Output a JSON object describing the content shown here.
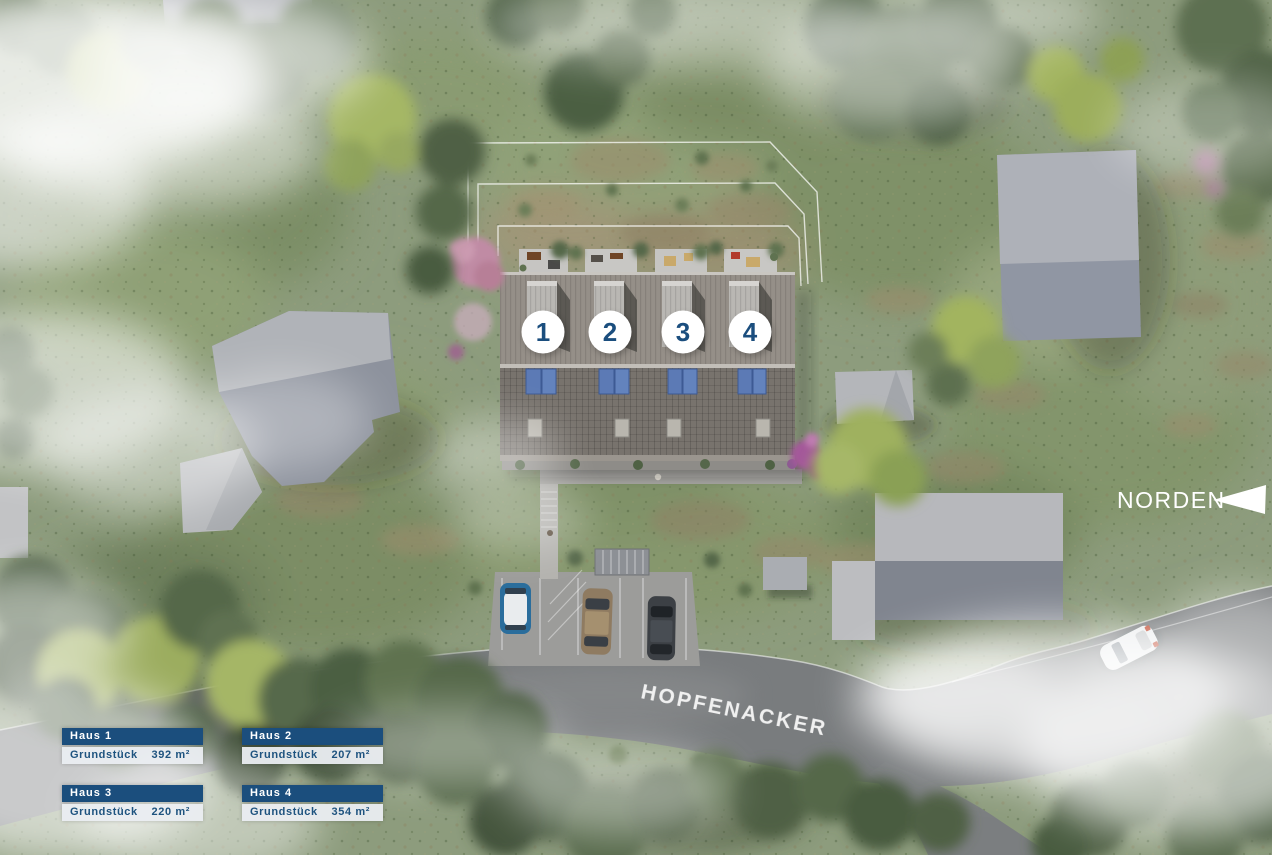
{
  "labels": {
    "north": "NORDEN",
    "street": "HOPFENACKER"
  },
  "houses": [
    {
      "number": "1"
    },
    {
      "number": "2"
    },
    {
      "number": "3"
    },
    {
      "number": "4"
    }
  ],
  "info_boxes": [
    {
      "title": "Haus 1",
      "label": "Grundstück",
      "value": "392 m²"
    },
    {
      "title": "Haus 2",
      "label": "Grundstück",
      "value": "207 m²"
    },
    {
      "title": "Haus 3",
      "label": "Grundstück",
      "value": "220 m²"
    },
    {
      "title": "Haus 4",
      "label": "Grundstück",
      "value": "354 m²"
    }
  ],
  "colors": {
    "accent_blue": "#1b4e7d",
    "panel_bg": "#eaedf1",
    "text_blue": "#1e537f",
    "grass_green": "#8d9c7d",
    "road_gray": "#797c7e",
    "roof_light": "#b2b4ba",
    "roof_dark": "#8c92a0",
    "solar_blue": "#5c7ab5",
    "label_white": "#ffffff"
  }
}
